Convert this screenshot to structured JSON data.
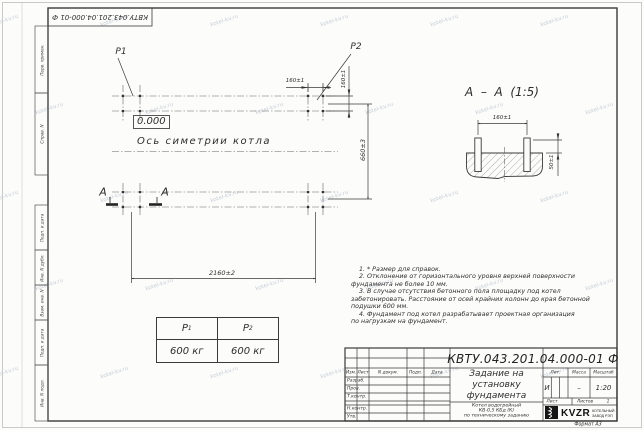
{
  "watermark": {
    "text": "kotel-kv.ru"
  },
  "doc": {
    "number": "КВТУ.043.201.04.000-01 Ф"
  },
  "margin_labels": [
    "Перв. примен.",
    "Справ. N",
    "Подп. и дата",
    "Инв. N дубл.",
    "Взам. инв. N",
    "Подп. и дата",
    "Инв. N подл."
  ],
  "plan": {
    "load1_label": "Р1",
    "load2_label": "Р2",
    "level_mark": "0.000",
    "axis_label": "Ось симетрии котла",
    "section_letter_left": "А",
    "section_letter_right": "А",
    "dim_bolt_x": "160±1",
    "dim_bolt_y": "160±1",
    "dim_length": "2160±2",
    "dim_width": "660±3"
  },
  "section": {
    "title": "А  –  А  (1:5)",
    "dim_bolt": "160±1",
    "dim_protrusion": "50±1"
  },
  "load_table": {
    "col1": {
      "letter": "Р",
      "sub": "1",
      "value": "600 кг"
    },
    "col2": {
      "letter": "Р",
      "sub": "2",
      "value": "600 кг"
    }
  },
  "notes": {
    "lines": [
      "    1. * Размер для справок.",
      "    2. Отклонение от горизонтального уровня верхней поверхности",
      "фундамента не более 10 мм.",
      "    3. В случае отсутствия бетонного пола площадку под котел",
      "забетонировать. Расстояние от осей крайних колонн до края бетонной",
      "подушки 600 мм.",
      "    4. Фундамент под котел разрабатывает проектная организация",
      "по нагрузкам на фундамент."
    ]
  },
  "title_block": {
    "header": {
      "izm": "Изм.",
      "list": "Лист",
      "ndoc": "N докум.",
      "podp": "Подп.",
      "data": "Дата"
    },
    "rows": [
      "Разраб.",
      "Пров.",
      "Т.контр.",
      "Н.контр.",
      "Утв."
    ],
    "title_lines": [
      "Задание на",
      "установку",
      "фундамента"
    ],
    "subtitle_lines": [
      "Котел водогрейный",
      "КВ-0,5 КБд (К)",
      "по техническому заданию"
    ],
    "lit_label": "Лит.",
    "lit_value": "И",
    "massa_label": "Масса",
    "massa_value": "–",
    "masshtab_label": "Масштаб",
    "masshtab_value": "1:20",
    "list_label": "Лист",
    "listov_label": "Листов",
    "listov_value": "1",
    "logo_text": "KVZR",
    "logo_caption1": "КОТЕЛЬНЫЙ",
    "logo_caption2": "ЗАВОД РЭП",
    "format_label": "Формат А3"
  }
}
